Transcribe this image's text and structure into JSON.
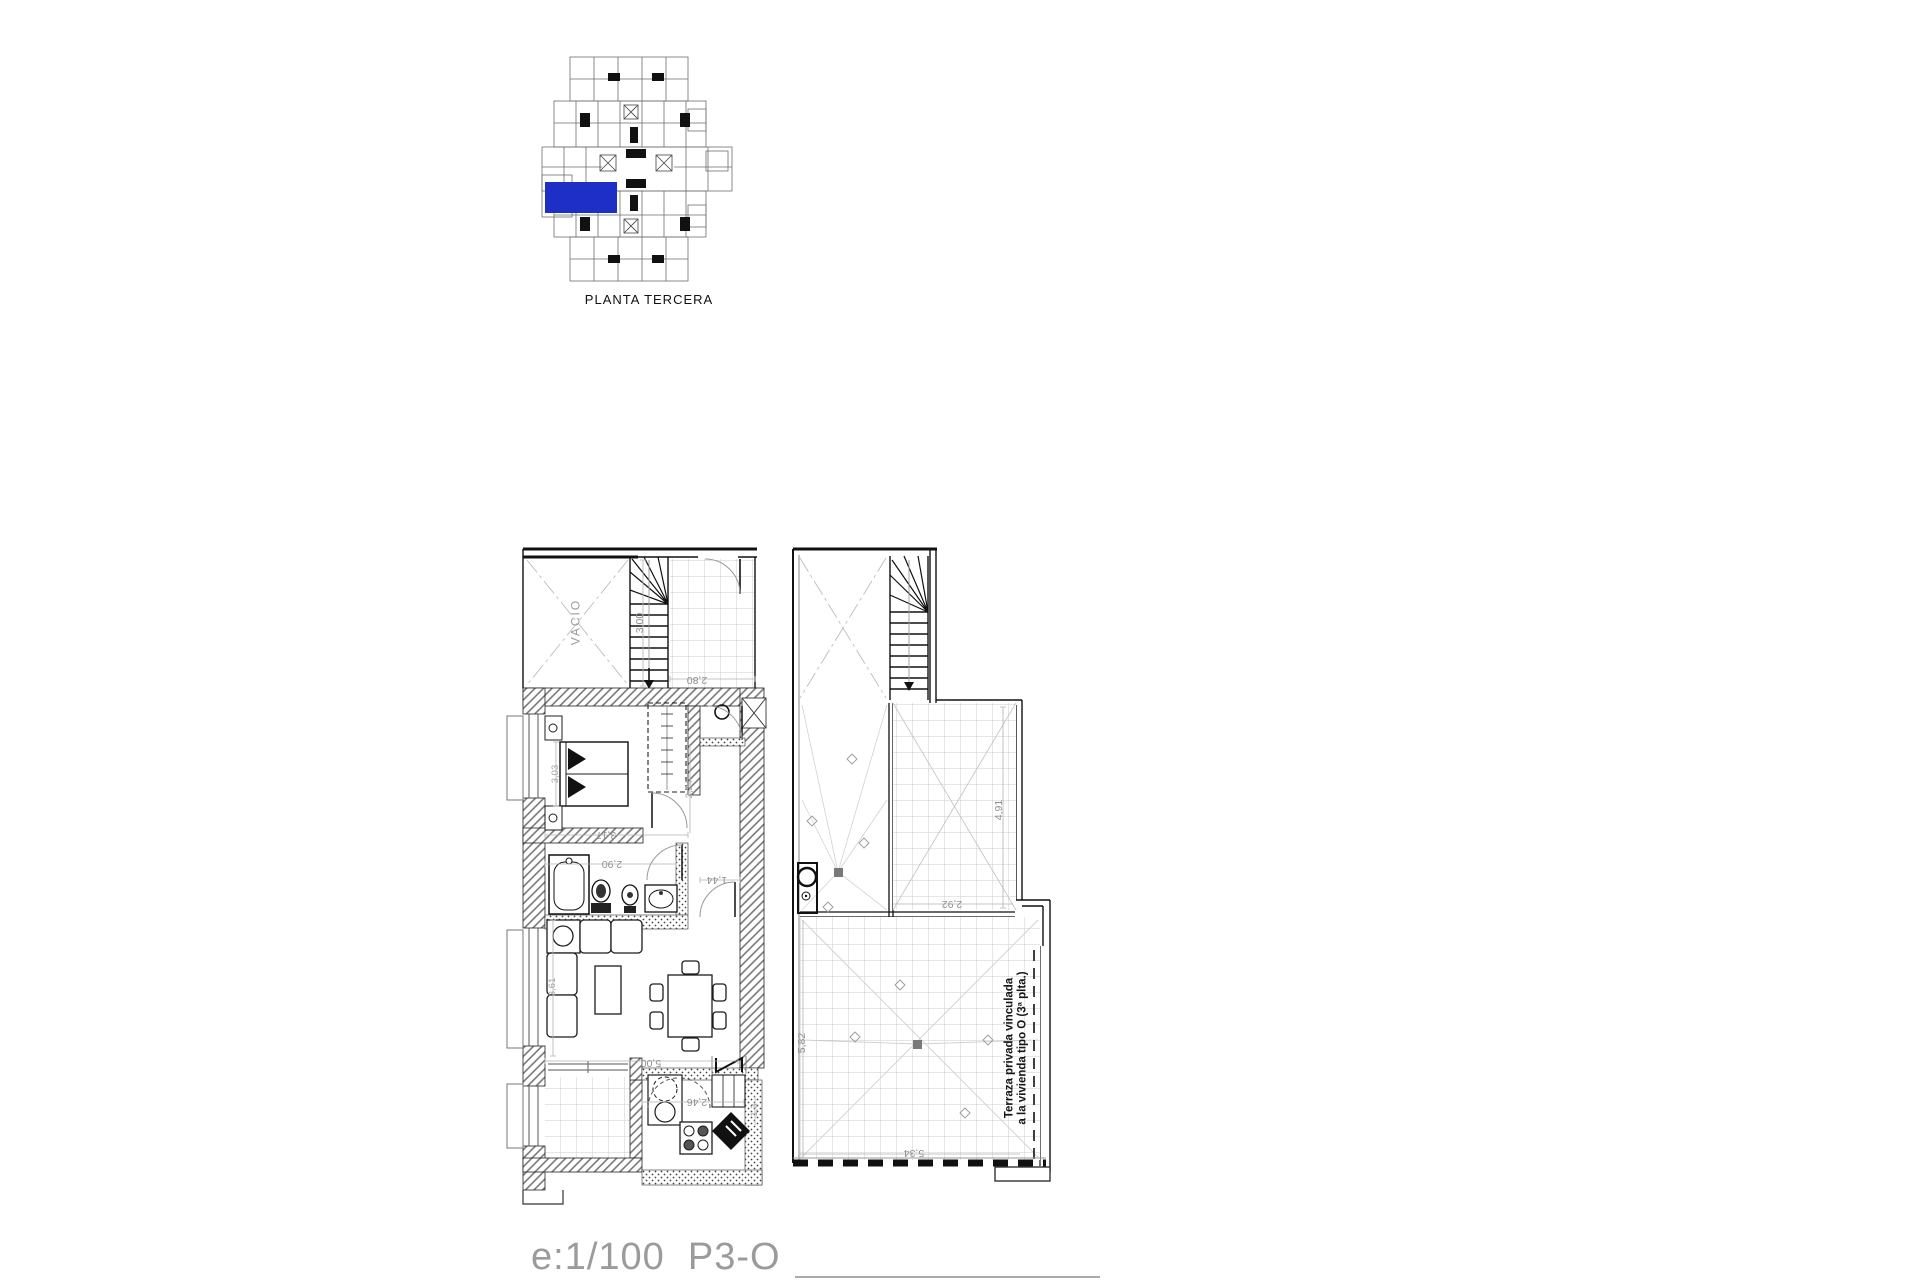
{
  "key_plan": {
    "caption": "PLANTA TERCERA",
    "highlight_color": "#1e2fc8"
  },
  "scale_label": "e:1/100  P3-O",
  "plan": {
    "labels": {
      "vacio": "VACIO",
      "stair_dim": "3,00",
      "landing_dim": "2,80",
      "bedroom_width": "3,03",
      "bedroom_length": "3,17",
      "bath_width": "2,90",
      "hall_width": "1,44",
      "hall_depth": "2,24",
      "living_width": "5,00",
      "living_depth": "3,61",
      "kitchen_width": "2,46",
      "kitchen_depth": "1,3",
      "terrace_upper_height": "4,91",
      "terrace_upper_width": "2,92",
      "terrace_lower_height": "5,82",
      "terrace_lower_width": "5,34",
      "terrace_note_line1": "Terraza privada vinculada",
      "terrace_note_line2": "a la vivienda tipo O (3ª plta.)"
    }
  }
}
